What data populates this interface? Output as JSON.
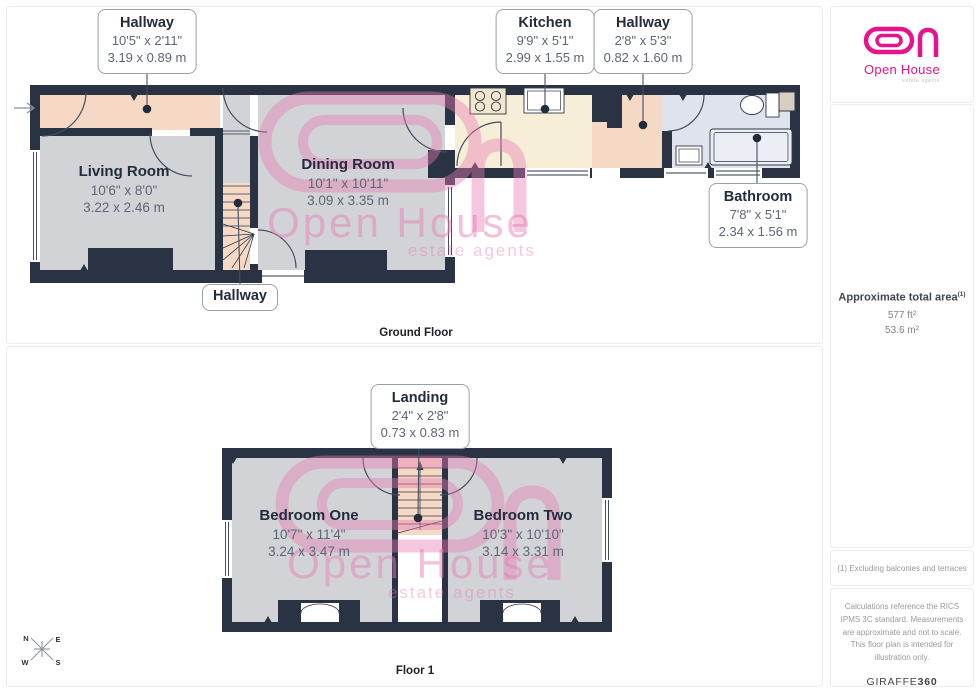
{
  "colors": {
    "wall": "#2a3343",
    "floor_grey": "#d2d3d6",
    "hallway_peach": "#f6d9c5",
    "kitchen_cream": "#f6eed7",
    "bathroom_blue": "#dfe3ee",
    "watermark_pink": "#e87cb5",
    "logo_pink": "#e6148c"
  },
  "ground": {
    "caption": "Ground Floor",
    "callouts": {
      "hallway1": {
        "title": "Hallway",
        "imperial": "10'5\" x 2'11\"",
        "metric": "3.19 x 0.89 m"
      },
      "kitchen": {
        "title": "Kitchen",
        "imperial": "9'9\" x 5'1\"",
        "metric": "2.99 x 1.55 m"
      },
      "hallway2": {
        "title": "Hallway",
        "imperial": "2'8\" x 5'3\"",
        "metric": "0.82 x 1.60 m"
      },
      "bathroom": {
        "title": "Bathroom",
        "imperial": "7'8\" x 5'1\"",
        "metric": "2.34 x 1.56 m"
      },
      "stairs": {
        "title": "Hallway"
      }
    },
    "rooms": {
      "living": {
        "title": "Living Room",
        "imperial": "10'6\" x 8'0\"",
        "metric": "3.22 x 2.46 m"
      },
      "dining": {
        "title": "Dining Room",
        "imperial": "10'1\" x 10'11\"",
        "metric": "3.09 x 3.35 m"
      }
    }
  },
  "floor1": {
    "caption": "Floor 1",
    "callouts": {
      "landing": {
        "title": "Landing",
        "imperial": "2'4\" x 2'8\"",
        "metric": "0.73 x 0.83 m"
      }
    },
    "rooms": {
      "bedroom1": {
        "title": "Bedroom One",
        "imperial": "10'7\" x 11'4\"",
        "metric": "3.24 x 3.47 m"
      },
      "bedroom2": {
        "title": "Bedroom Two",
        "imperial": "10'3\" x 10'10\"",
        "metric": "3.14 x 3.31 m"
      }
    }
  },
  "sidebar": {
    "logo": {
      "name": "Open House",
      "tagline": "estate agents"
    },
    "area": {
      "title": "Approximate total area",
      "sup": "(1)",
      "ft": "577 ft²",
      "m": "53.6 m²"
    },
    "footnote": "(1) Excluding balconies and terraces",
    "disclaimer": "Calculations reference the RICS IPMS 3C standard. Measurements are approximate and not to scale. This floor plan is intended for illustration only.",
    "brand": {
      "name": "GIRAFFE",
      "suffix": "360"
    }
  },
  "watermark": {
    "name": "Open House",
    "tagline": "estate agents"
  },
  "compass": {
    "n": "N",
    "e": "E",
    "w": "W",
    "s": "S"
  }
}
